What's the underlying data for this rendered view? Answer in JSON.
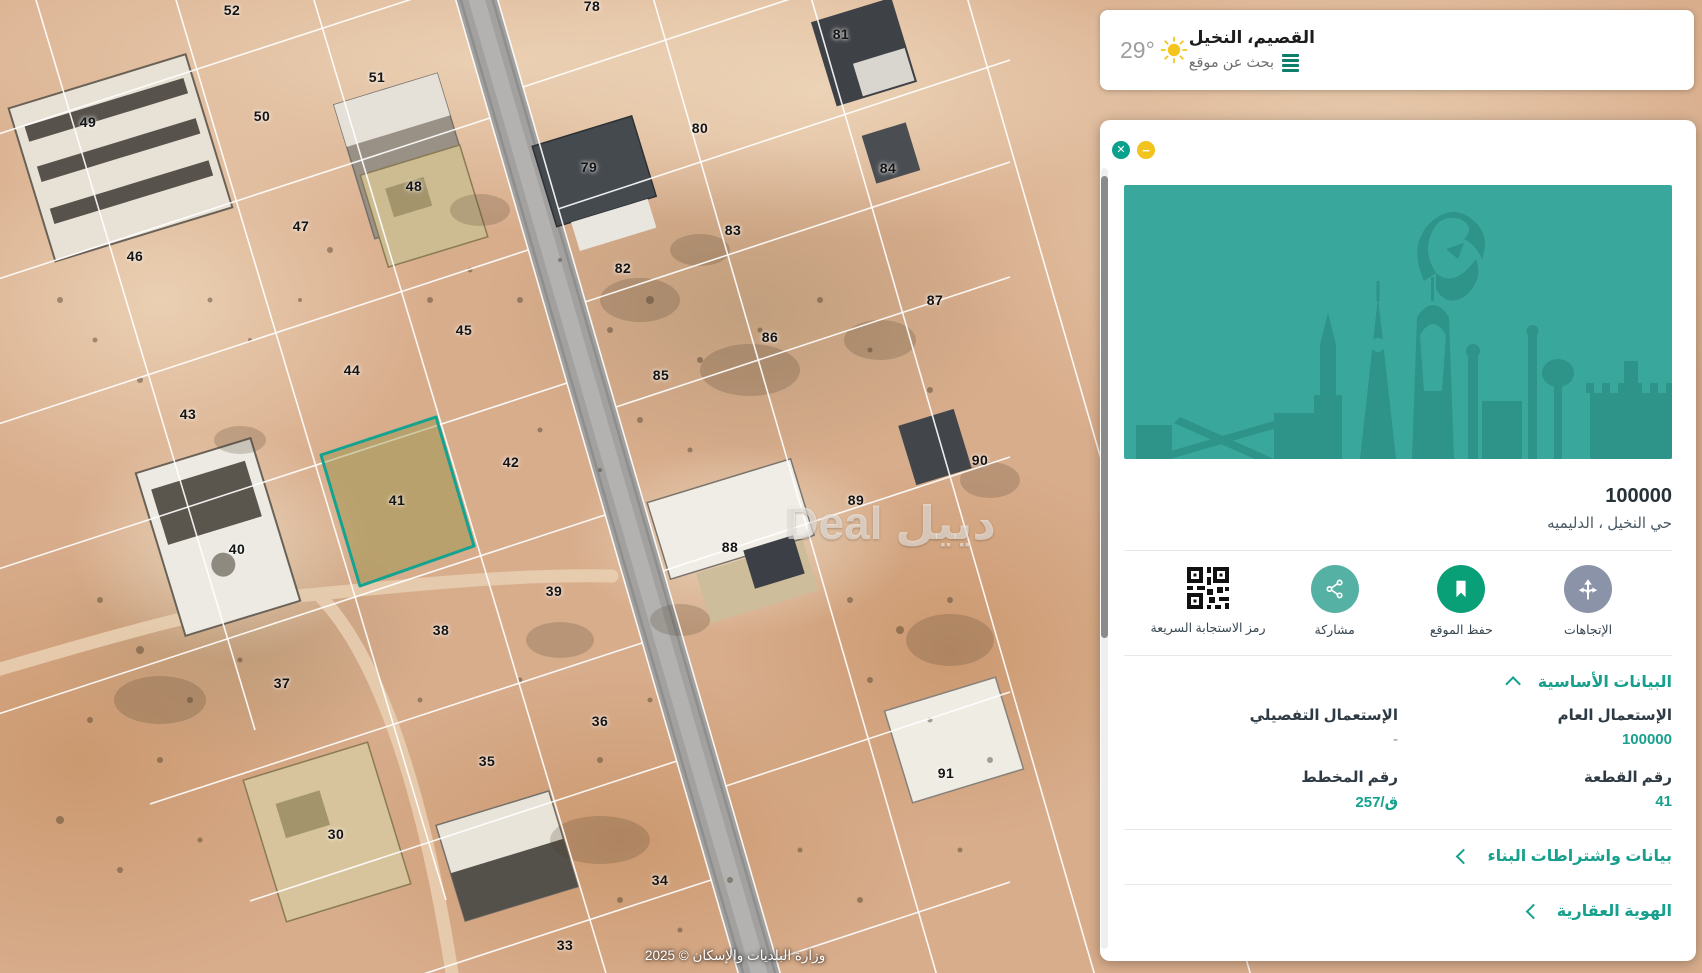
{
  "header": {
    "temperature": "29°",
    "location_title": "القصيم، النخيل",
    "search_label": "بحث عن موقع"
  },
  "map": {
    "watermark": "دييل Deal",
    "attribution": "وزارة البلديات والإسكان © 2025",
    "highlighted_parcel": "41",
    "parcels": [
      {
        "n": "52",
        "x": 232,
        "y": 10
      },
      {
        "n": "51",
        "x": 377,
        "y": 77
      },
      {
        "n": "50",
        "x": 262,
        "y": 116
      },
      {
        "n": "49",
        "x": 88,
        "y": 122
      },
      {
        "n": "48",
        "x": 414,
        "y": 186
      },
      {
        "n": "47",
        "x": 301,
        "y": 226
      },
      {
        "n": "46",
        "x": 135,
        "y": 256
      },
      {
        "n": "45",
        "x": 464,
        "y": 330
      },
      {
        "n": "44",
        "x": 352,
        "y": 370
      },
      {
        "n": "43",
        "x": 188,
        "y": 414
      },
      {
        "n": "42",
        "x": 511,
        "y": 462
      },
      {
        "n": "41",
        "x": 397,
        "y": 500
      },
      {
        "n": "40",
        "x": 237,
        "y": 549
      },
      {
        "n": "39",
        "x": 554,
        "y": 591
      },
      {
        "n": "38",
        "x": 441,
        "y": 630
      },
      {
        "n": "37",
        "x": 282,
        "y": 683
      },
      {
        "n": "36",
        "x": 600,
        "y": 721
      },
      {
        "n": "35",
        "x": 487,
        "y": 761
      },
      {
        "n": "30",
        "x": 336,
        "y": 834
      },
      {
        "n": "34",
        "x": 660,
        "y": 880
      },
      {
        "n": "33",
        "x": 565,
        "y": 945
      },
      {
        "n": "78",
        "x": 592,
        "y": 6
      },
      {
        "n": "81",
        "x": 841,
        "y": 34
      },
      {
        "n": "80",
        "x": 700,
        "y": 128
      },
      {
        "n": "79",
        "x": 589,
        "y": 167
      },
      {
        "n": "84",
        "x": 888,
        "y": 168
      },
      {
        "n": "83",
        "x": 733,
        "y": 230
      },
      {
        "n": "82",
        "x": 623,
        "y": 268
      },
      {
        "n": "87",
        "x": 935,
        "y": 300
      },
      {
        "n": "86",
        "x": 770,
        "y": 337
      },
      {
        "n": "85",
        "x": 661,
        "y": 375
      },
      {
        "n": "90",
        "x": 980,
        "y": 460
      },
      {
        "n": "89",
        "x": 856,
        "y": 500
      },
      {
        "n": "88",
        "x": 730,
        "y": 547
      },
      {
        "n": "91",
        "x": 946,
        "y": 773
      }
    ]
  },
  "panel": {
    "title": "100000",
    "subtitle": "حي النخيل ، الدليميه",
    "actions": [
      {
        "label": "الإتجاهات"
      },
      {
        "label": "حفظ الموقع"
      },
      {
        "label": "مشاركة"
      },
      {
        "label": "رمز الاستجابة السريعة"
      }
    ],
    "sections": {
      "basic": "البيانات الأساسية",
      "building": "بيانات واشتراطات البناء",
      "identity": "الهوية العقارية"
    },
    "fields": [
      {
        "label": "الإستعمال العام",
        "value": "100000"
      },
      {
        "label": "الإستعمال التفصيلي",
        "value": "-"
      },
      {
        "label": "رقم القطعة",
        "value": "41"
      },
      {
        "label": "رقم المخطط",
        "value": "ق/257"
      }
    ]
  }
}
